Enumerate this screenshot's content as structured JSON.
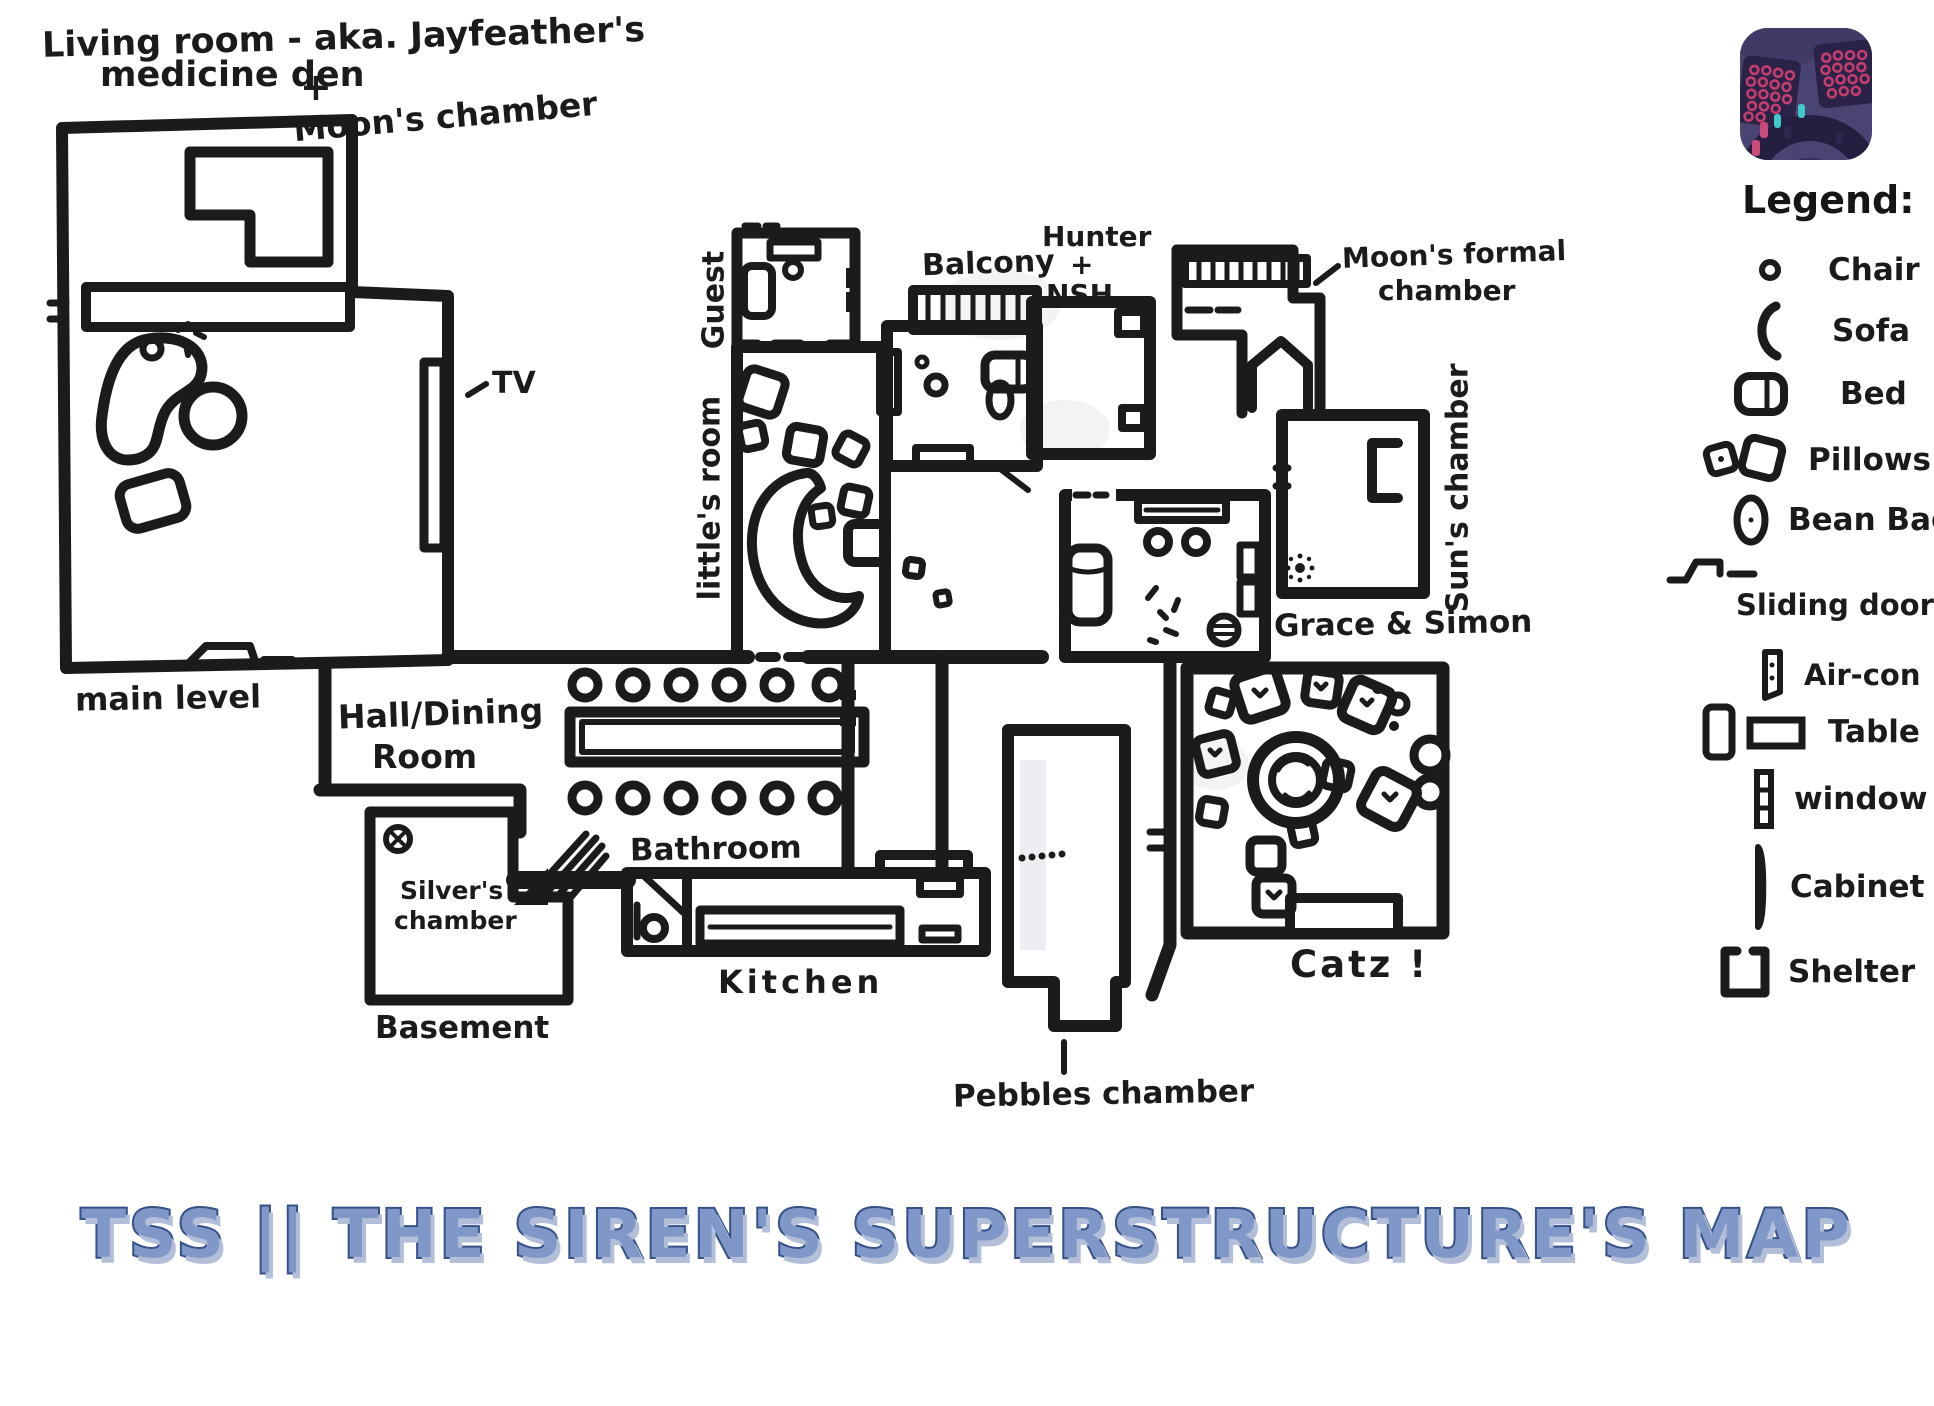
{
  "map": {
    "ink_color": "#1b1b1b",
    "labels": {
      "living1": "Living room - aka. Jayfeather's",
      "living2": "medicine den",
      "plus": "+",
      "moons_chamber": "Moon's chamber",
      "tv": "TV",
      "main_level": "main level",
      "hall1": "Hall/Dining",
      "hall2": "Room",
      "silver1": "Silver's",
      "silver2": "chamber",
      "basement": "Basement",
      "bathroom": "Bathroom",
      "kitchen": "Kitchen",
      "guest": "Guest",
      "littles_room": "little's room",
      "balcony": "Balcony",
      "hunter1": "Hunter",
      "hunter2": "+",
      "hunter3": "NSH",
      "moons_formal1": "Moon's formal",
      "moons_formal2": "chamber",
      "suns_chamber": "Sun's chamber",
      "grace_simon": "Grace & Simon",
      "pebbles_chamber": "Pebbles chamber",
      "catz": "Catz !"
    }
  },
  "legend": {
    "title": "Legend:",
    "items": [
      {
        "icon": "chair-icon",
        "label": "Chair"
      },
      {
        "icon": "sofa-icon",
        "label": "Sofa"
      },
      {
        "icon": "bed-icon",
        "label": "Bed"
      },
      {
        "icon": "pillows-icon",
        "label": "Pillows"
      },
      {
        "icon": "bean-bag-icon",
        "label": "Bean Bag"
      },
      {
        "icon": "sliding-door-icon",
        "label": "Sliding door"
      },
      {
        "icon": "air-con-icon",
        "label": "Air-con"
      },
      {
        "icon": "table-icon",
        "label": "Table"
      },
      {
        "icon": "window-icon",
        "label": "window"
      },
      {
        "icon": "cabinet-icon",
        "label": "Cabinet"
      },
      {
        "icon": "shelter-icon",
        "label": "Shelter"
      }
    ]
  },
  "title": {
    "text": "TSS || THE SIREN'S SUPERSTRUCTURE'S MAP",
    "fill_color": "#7f98c8",
    "outline_color": "#36508a"
  },
  "thumbnail": {
    "icon": "game-screenshot-app-icon",
    "bg_color": "#4a4472",
    "accent_pink": "#c43e6d",
    "accent_teal": "#3fc9c9"
  }
}
